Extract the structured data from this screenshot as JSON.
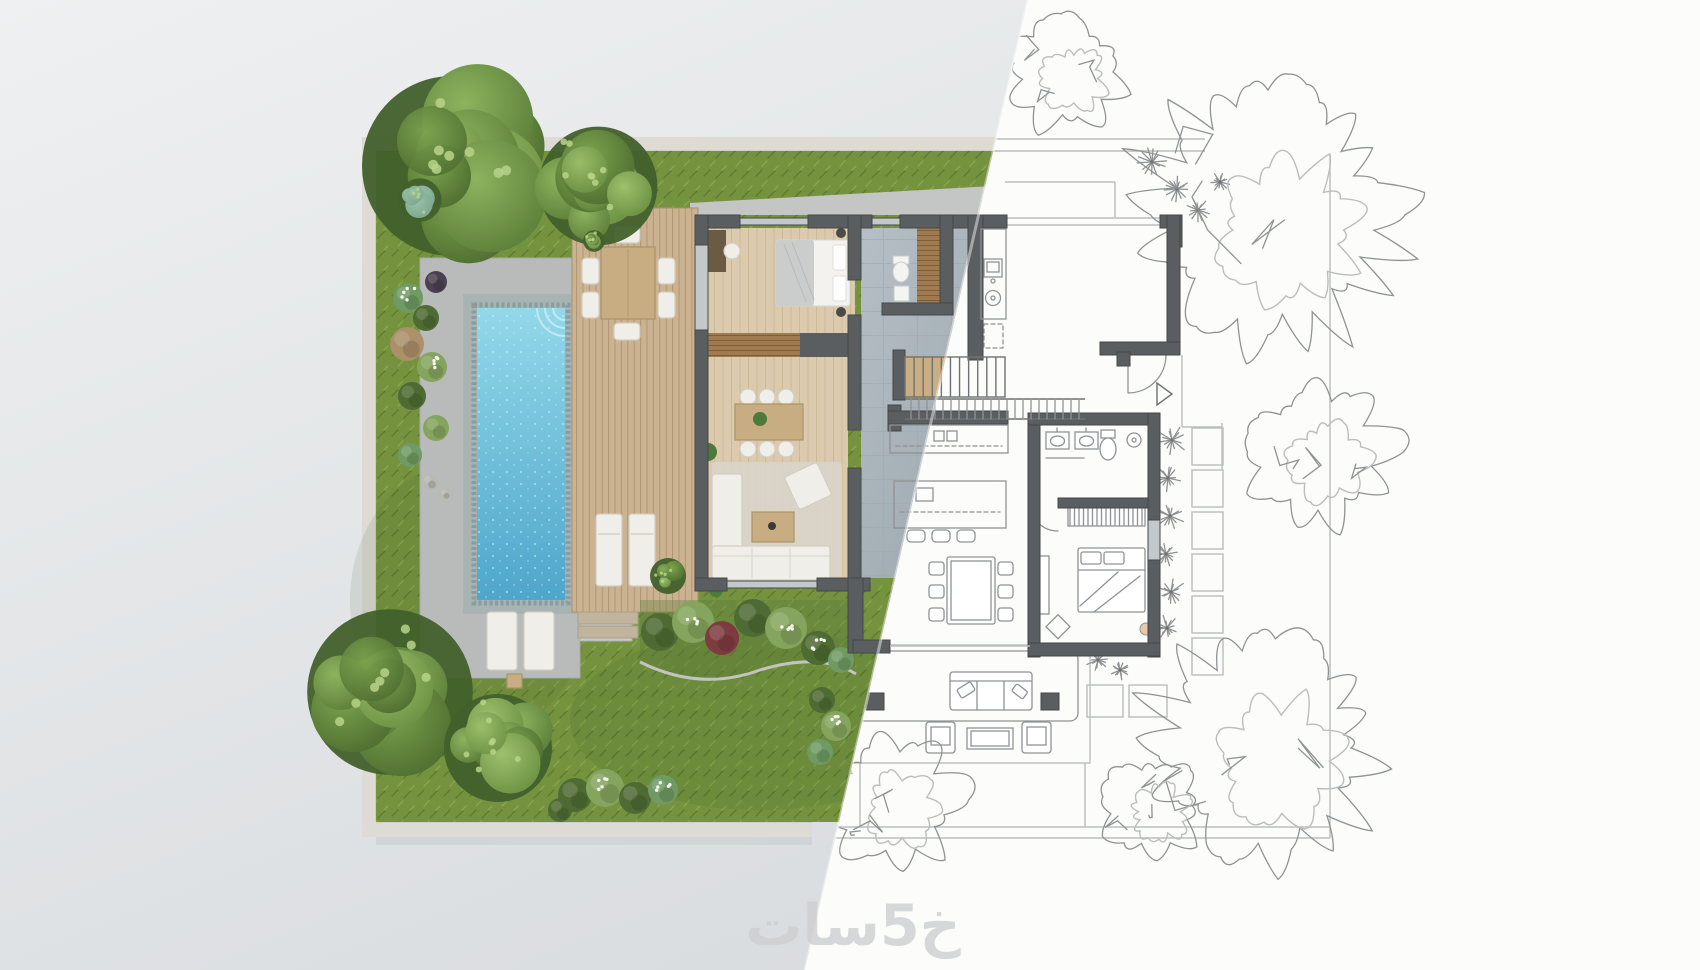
{
  "watermark": {
    "text": "خ5سات"
  },
  "split": {
    "top_x": 1028,
    "bottom_x": 805
  },
  "site": {
    "left": 362,
    "top": 137,
    "right": 1330,
    "bottom": 838
  },
  "palette": {
    "bgA": "#eef0f1",
    "bgB": "#d7dadd",
    "bgRight": "#fcfcfa",
    "grass": "#75933f",
    "grassD": "#5d7a30",
    "grassL": "#8aa74e",
    "paving": "#b8bbb9",
    "pavingL": "#c8cbc9",
    "pool1": "#93d8e9",
    "pool2": "#4ea6cb",
    "poolB": "#a9b4b2",
    "poolBd": "#7c959b",
    "deck": "#cbb291",
    "deckL": "#b09671",
    "wood": "#dccaae",
    "woodL": "#cdb795",
    "tile1": "#b6bfc5",
    "tile2": "#97a2aa",
    "tileL": "#a2acb3",
    "wall": "#5a5e60",
    "wallEdge": "#454849",
    "sk": "#8f9294",
    "skL": "#bbbdbe",
    "skD": "#6e7173",
    "win": "#c3c9ca",
    "bound": "#dddbd4",
    "concrete": "#c3c6c4",
    "treeDark": "#41602b",
    "treeA1": "#8db35e",
    "treeA2": "#5b7d38",
    "treeB1": "#7ca34f",
    "treeB2": "#4c6c2e",
    "treeC1": "#9cc06c",
    "treeC2": "#6a8f41",
    "treeLight": "#b7d489",
    "teal": "#7aa58c",
    "sA": "#6f9a63",
    "sB": "#4e6b33",
    "sC": "#85a55e",
    "sBr": "#ab906a",
    "sM": "#7e3c40",
    "sP": "#4b4050",
    "stone": "#b9b9b3",
    "furnW": "#f0eee8",
    "furnS": "#d2cec4",
    "woodF": "#c9ad82",
    "woodFS": "#a8946a",
    "wm": "#cdcfd0"
  },
  "render_trees": [
    {
      "cx": 452,
      "cy": 166,
      "r": 100,
      "seed": 1
    },
    {
      "cx": 598,
      "cy": 186,
      "r": 66,
      "seed": 2
    },
    {
      "cx": 420,
      "cy": 200,
      "r": 24,
      "seed": 3,
      "tone": "teal"
    },
    {
      "cx": 390,
      "cy": 692,
      "r": 92,
      "seed": 4
    },
    {
      "cx": 498,
      "cy": 748,
      "r": 60,
      "seed": 5
    },
    {
      "cx": 668,
      "cy": 576,
      "r": 20,
      "seed": 6
    },
    {
      "cx": 594,
      "cy": 241,
      "r": 12,
      "seed": 7
    }
  ],
  "sketch_trees": [
    {
      "cx": 1268,
      "cy": 215,
      "r": 150,
      "seed": 11
    },
    {
      "cx": 1066,
      "cy": 72,
      "r": 66,
      "seed": 12
    },
    {
      "cx": 1318,
      "cy": 452,
      "r": 82,
      "seed": 13
    },
    {
      "cx": 1262,
      "cy": 748,
      "r": 132,
      "seed": 14
    },
    {
      "cx": 893,
      "cy": 800,
      "r": 76,
      "seed": 15
    },
    {
      "cx": 1152,
      "cy": 806,
      "r": 58,
      "seed": 16
    }
  ],
  "starbursts": [
    [
      1152,
      162,
      15
    ],
    [
      1177,
      189,
      13
    ],
    [
      1198,
      210,
      12
    ],
    [
      1220,
      182,
      10
    ],
    [
      1172,
      440,
      16
    ],
    [
      1168,
      478,
      14
    ],
    [
      1170,
      516,
      15
    ],
    [
      1166,
      554,
      13
    ],
    [
      1171,
      592,
      15
    ],
    [
      1167,
      628,
      13
    ],
    [
      1098,
      660,
      12
    ],
    [
      1120,
      670,
      10
    ]
  ],
  "shrubs": {
    "left_strip": [
      [
        408,
        298,
        15,
        "sA"
      ],
      [
        426,
        318,
        13,
        "sB"
      ],
      [
        407,
        344,
        17,
        "sBr"
      ],
      [
        432,
        367,
        15,
        "sC"
      ],
      [
        412,
        396,
        14,
        "sB"
      ],
      [
        436,
        428,
        13,
        "sC"
      ],
      [
        410,
        455,
        12,
        "sA"
      ],
      [
        436,
        282,
        11,
        "sP"
      ],
      [
        430,
        482,
        8,
        "stone"
      ],
      [
        445,
        494,
        6,
        "stone"
      ]
    ],
    "flower_bed": [
      [
        660,
        632,
        19,
        "sB"
      ],
      [
        693,
        622,
        21,
        "sC"
      ],
      [
        722,
        638,
        17,
        "sM"
      ],
      [
        753,
        618,
        19,
        "sB"
      ],
      [
        786,
        628,
        21,
        "sC"
      ],
      [
        818,
        648,
        17,
        "sB"
      ],
      [
        841,
        660,
        13,
        "sA"
      ]
    ],
    "bottom_hedge": [
      [
        575,
        795,
        17,
        "sB"
      ],
      [
        605,
        788,
        19,
        "sC"
      ],
      [
        635,
        798,
        16,
        "sB"
      ],
      [
        663,
        790,
        15,
        "sA"
      ],
      [
        560,
        810,
        12,
        "sB"
      ],
      [
        822,
        700,
        13,
        "sB"
      ],
      [
        836,
        726,
        15,
        "sC"
      ],
      [
        820,
        752,
        13,
        "sA"
      ]
    ],
    "flowers": [
      [
        693,
        618
      ],
      [
        786,
        624
      ],
      [
        818,
        644
      ],
      [
        605,
        784
      ],
      [
        663,
        786
      ],
      [
        836,
        722
      ],
      [
        408,
        294
      ],
      [
        432,
        363
      ]
    ]
  },
  "stepping_stones": {
    "column": {
      "x": 1192,
      "w": 31,
      "h": 37,
      "gap": 5,
      "start_y": 428,
      "count": 6
    },
    "extra": [
      [
        1087,
        685,
        36,
        32
      ],
      [
        1129,
        685,
        38,
        32
      ]
    ]
  },
  "stairs": {
    "x": 905,
    "y": 357,
    "w": 100,
    "h": 40,
    "treads": 11,
    "rail_x2": 1085,
    "rail_y1": 399,
    "rail_y2": 419,
    "rail_step": 8
  }
}
